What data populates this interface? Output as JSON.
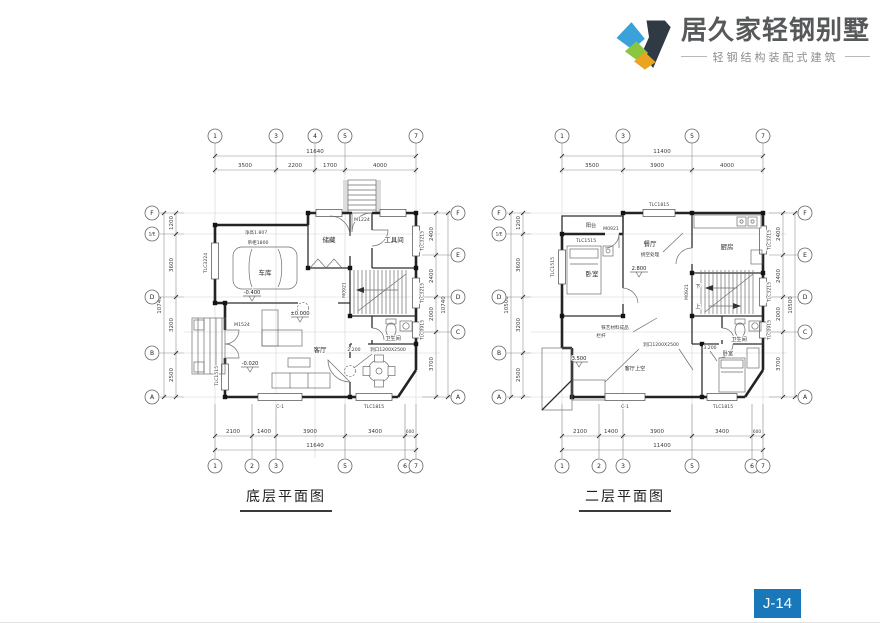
{
  "header": {
    "brand": "居久家轻钢别墅",
    "tagline": "轻钢结构装配式建筑",
    "logo_colors": {
      "blue": "#3ba1d9",
      "green": "#8cc63e",
      "yellow": "#e9a51f",
      "dark": "#2f3a45"
    }
  },
  "badge": {
    "label": "J-14",
    "bg": "#1878ba"
  },
  "ground": {
    "caption": "底层平面图",
    "grid": {
      "top": [
        "1",
        "3",
        "4",
        "5",
        "7"
      ],
      "bottom": [
        "1",
        "2",
        "3",
        "5",
        "6",
        "7"
      ],
      "left": [
        "F",
        "1/E",
        "D",
        "B",
        "A"
      ],
      "right": [
        "F",
        "E",
        "D",
        "C",
        "A"
      ]
    },
    "dims": {
      "top_total": "11640",
      "top": [
        "3500",
        "2200",
        "1700",
        "4000"
      ],
      "bottom": [
        "2100",
        "1400",
        "3900",
        "3400",
        "600"
      ],
      "bottom_total": "11640",
      "left": [
        "1200",
        "3600",
        "3200",
        "2500"
      ],
      "left_total": "10740",
      "right": [
        "2400",
        "2400",
        "2000",
        "3700"
      ],
      "right_total": "10740"
    },
    "rooms": {
      "garage": "车库",
      "storage": "储藏",
      "tool": "工具间",
      "living": "客厅",
      "bath": "卫生间"
    },
    "levels": {
      "garage": "-0.400",
      "main": "±0.000",
      "entry": "-0.020"
    },
    "notes": {
      "height": "净高1.807",
      "cabinet": "吊柜1800",
      "opening": "洞口1200X2500",
      "opening_lvl": "2.200"
    },
    "tags": {
      "m1224": "M1224",
      "m1524": "M1524",
      "m0921": "M0921",
      "c1": "C-1",
      "tlc1815": "TLC1815",
      "tlc3224": "TLC3224",
      "tlc1515": "TLC1515",
      "tlc3215a": "TLC3215",
      "tlc3215b": "TLC3215",
      "tlc0915": "TLC0915"
    }
  },
  "second": {
    "caption": "二层平面图",
    "grid": {
      "top": [
        "1",
        "3",
        "5",
        "7"
      ],
      "bottom": [
        "1",
        "2",
        "3",
        "5",
        "6",
        "7"
      ],
      "left": [
        "F",
        "1/E",
        "D",
        "B",
        "A"
      ],
      "right": [
        "F",
        "E",
        "D",
        "C",
        "A"
      ]
    },
    "dims": {
      "top_total": "11400",
      "top": [
        "3500",
        "3900",
        "4000"
      ],
      "bottom": [
        "2100",
        "1400",
        "3900",
        "3400",
        "600"
      ],
      "bottom_total": "11400",
      "left": [
        "1200",
        "3600",
        "3200",
        "2500"
      ],
      "left_total": "10500",
      "right": [
        "2400",
        "2400",
        "2000",
        "3700"
      ],
      "right_total": "10500"
    },
    "rooms": {
      "balcony": "阳台",
      "bedroom_l": "卧室",
      "dining": "餐厅",
      "kitchen": "厨房",
      "bath": "卫生间",
      "bedroom_r": "卧室",
      "void": "客厅上空"
    },
    "levels": {
      "dining": "2.800",
      "terrace": "3.500",
      "bedroom": "3.200"
    },
    "notes": {
      "dining_note": "挑空处理",
      "opening": "洞口1200X2500",
      "railing1": "铁艺材料成品",
      "railing2": "栏杆",
      "down": "下",
      "up": "上"
    },
    "tags": {
      "tlc1815_top": "TLC1815",
      "m0921_balc": "M0921",
      "tlc1515_in": "TLC1515",
      "m0921_stair": "M0921",
      "c1": "C-1",
      "tlc1815_btm": "TLC1815",
      "tlc1515_l": "TLC1515",
      "tlc3215a": "TLC3215",
      "tlc3215b": "TLC3215",
      "tlc0915": "TLC0915"
    }
  }
}
